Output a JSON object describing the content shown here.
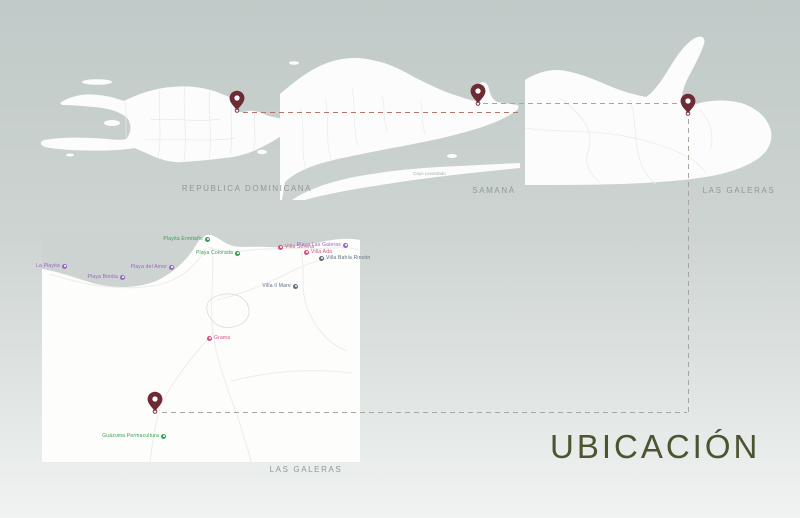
{
  "title": {
    "text": "UBICACIÓN"
  },
  "maps": {
    "republica_dominicana": {
      "label": "REPÚBLICA DOMINICANA"
    },
    "samana": {
      "label": "SAMANÁ"
    },
    "las_galeras_region": {
      "label": "LAS GALERAS"
    },
    "las_galeras_town": {
      "label": "LAS GALERAS"
    }
  },
  "island_label": {
    "text": "Cayo Levantado"
  },
  "pins": [
    {
      "id": "pin-republica-dominicana",
      "x": 237,
      "y": 111
    },
    {
      "id": "pin-samana",
      "x": 478,
      "y": 104
    },
    {
      "id": "pin-las-galeras-region",
      "x": 688,
      "y": 114
    },
    {
      "id": "pin-las-galeras-town",
      "x": 155,
      "y": 412
    }
  ],
  "route_lines": [
    {
      "id": "route-rd-to-samana",
      "x1": 243,
      "y1": 112,
      "x2": 519,
      "y2": 112,
      "color_key": "line_red"
    },
    {
      "id": "route-samana-to-region",
      "x1": 483,
      "y1": 103,
      "x2": 680,
      "y2": 103,
      "color_key": "line_gray"
    },
    {
      "id": "route-region-down",
      "x1": 688,
      "y1": 119,
      "x2": 688,
      "y2": 412,
      "color_key": "line_gray"
    },
    {
      "id": "route-bottom-to-town",
      "x1": 162,
      "y1": 412,
      "x2": 687,
      "y2": 412,
      "color_key": "line_gray"
    }
  ],
  "town_markers": [
    {
      "label": "La Playita",
      "color_key": "marker_purple",
      "x": 64,
      "y": 266,
      "side": "left"
    },
    {
      "label": "Playa Bonita",
      "color_key": "marker_purple",
      "x": 122,
      "y": 277,
      "side": "left"
    },
    {
      "label": "Playa del Amor",
      "color_key": "marker_purple",
      "x": 171,
      "y": 267,
      "side": "left"
    },
    {
      "label": "Playita Ermitaño",
      "color_key": "marker_green",
      "x": 207,
      "y": 239,
      "side": "left"
    },
    {
      "label": "Playa Colorada",
      "color_key": "marker_green",
      "x": 237,
      "y": 253,
      "side": "left"
    },
    {
      "label": "Villa Serena",
      "color_key": "marker_pink",
      "x": 281,
      "y": 247,
      "side": "right"
    },
    {
      "label": "Villa Ada",
      "color_key": "marker_pink",
      "x": 307,
      "y": 252,
      "side": "right"
    },
    {
      "label": "Playa Las Galeras",
      "color_key": "marker_purple",
      "x": 345,
      "y": 245,
      "side": "left"
    },
    {
      "label": "Villa Bahía Rincón",
      "color_key": "marker_dark",
      "x": 322,
      "y": 258,
      "side": "right"
    },
    {
      "label": "Villa Il Mare",
      "color_key": "marker_dark",
      "x": 295,
      "y": 286,
      "side": "left"
    },
    {
      "label": "Grama",
      "color_key": "marker_pink",
      "x": 210,
      "y": 338,
      "side": "right"
    },
    {
      "label": "Guázuma Permacultura",
      "color_key": "marker_green",
      "x": 163,
      "y": 436,
      "side": "left"
    }
  ],
  "colors": {
    "pin": "#6e2b33",
    "line_red": "#b4756a",
    "line_gray": "#a9a69d",
    "label": "#8f9995",
    "title": "#4d5430",
    "sea": "#ccd3d0",
    "land": "#fcfcfc",
    "marker_green": "#3a9c52",
    "marker_purple": "#9b63c6",
    "marker_pink": "#d44d83",
    "marker_dark": "#5d6d7b"
  }
}
